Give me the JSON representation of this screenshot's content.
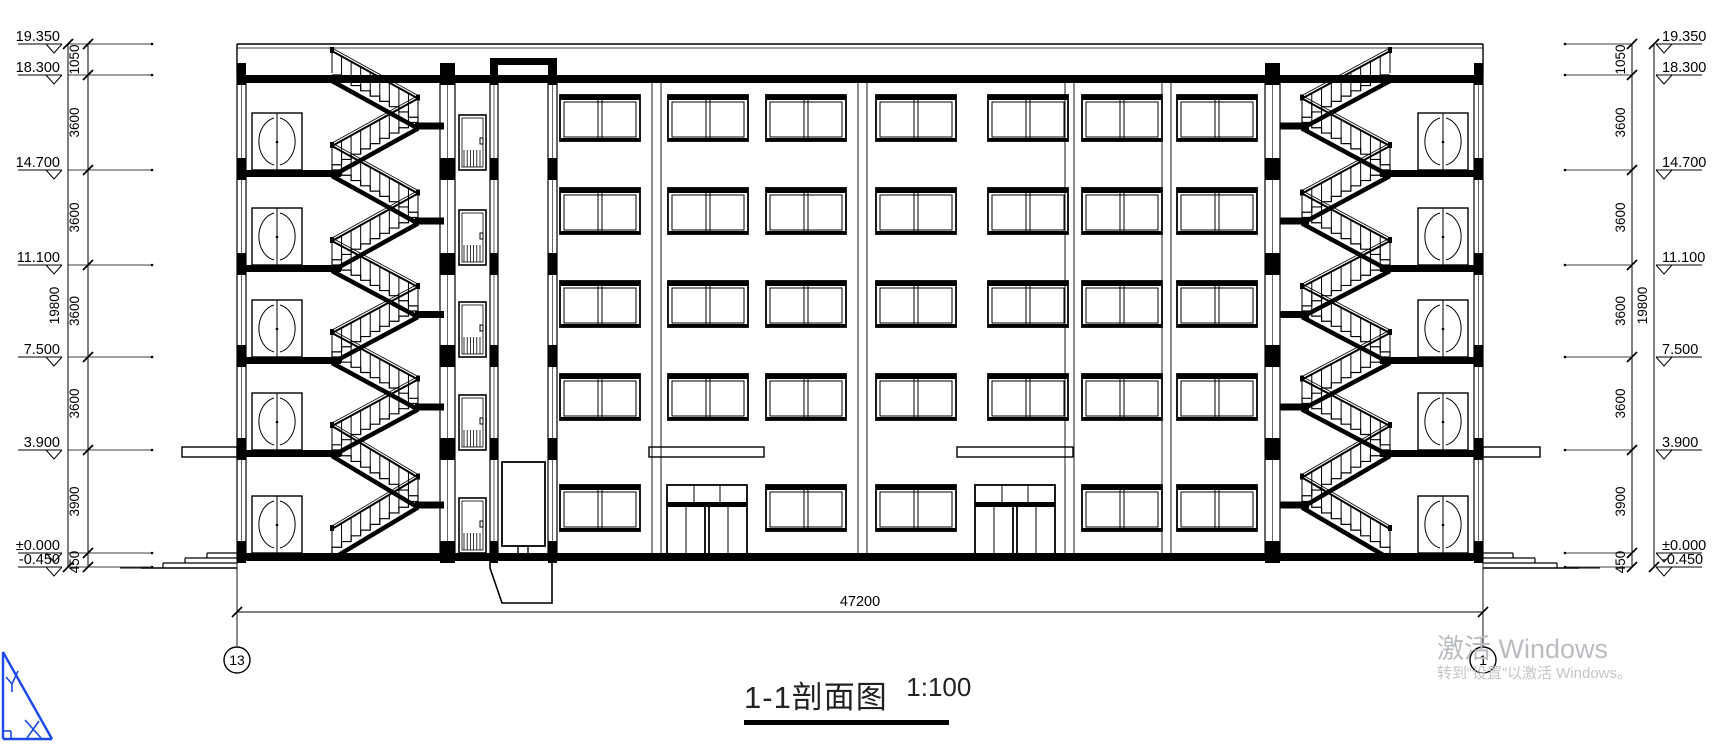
{
  "drawing": {
    "name": "building-section-1-1",
    "title": "1-1剖面图",
    "scale": "1:100",
    "bottom_dim": "47200",
    "axis_bubbles": {
      "left": "13",
      "right": "1"
    },
    "levels": [
      {
        "label": "19.350",
        "y": 44
      },
      {
        "label": "18.300",
        "y": 75
      },
      {
        "label": "14.700",
        "y": 170
      },
      {
        "label": "11.100",
        "y": 265
      },
      {
        "label": "7.500",
        "y": 357
      },
      {
        "label": "3.900",
        "y": 450
      },
      {
        "label": "±0.000",
        "y": 553
      },
      {
        "label": "-0.450",
        "y": 567
      }
    ],
    "dim_segments": [
      "1050",
      "3600",
      "3600",
      "3600",
      "3600",
      "3900",
      "450"
    ],
    "dim_total": "19800",
    "line_color": "#000000"
  },
  "watermark": {
    "line1": "激活 Windows",
    "line2": "转到“设置”以激活 Windows。",
    "color": "#b9bcc0"
  },
  "logo": {
    "name": "drafting-triangle-logo",
    "color": "#1c49e8"
  }
}
